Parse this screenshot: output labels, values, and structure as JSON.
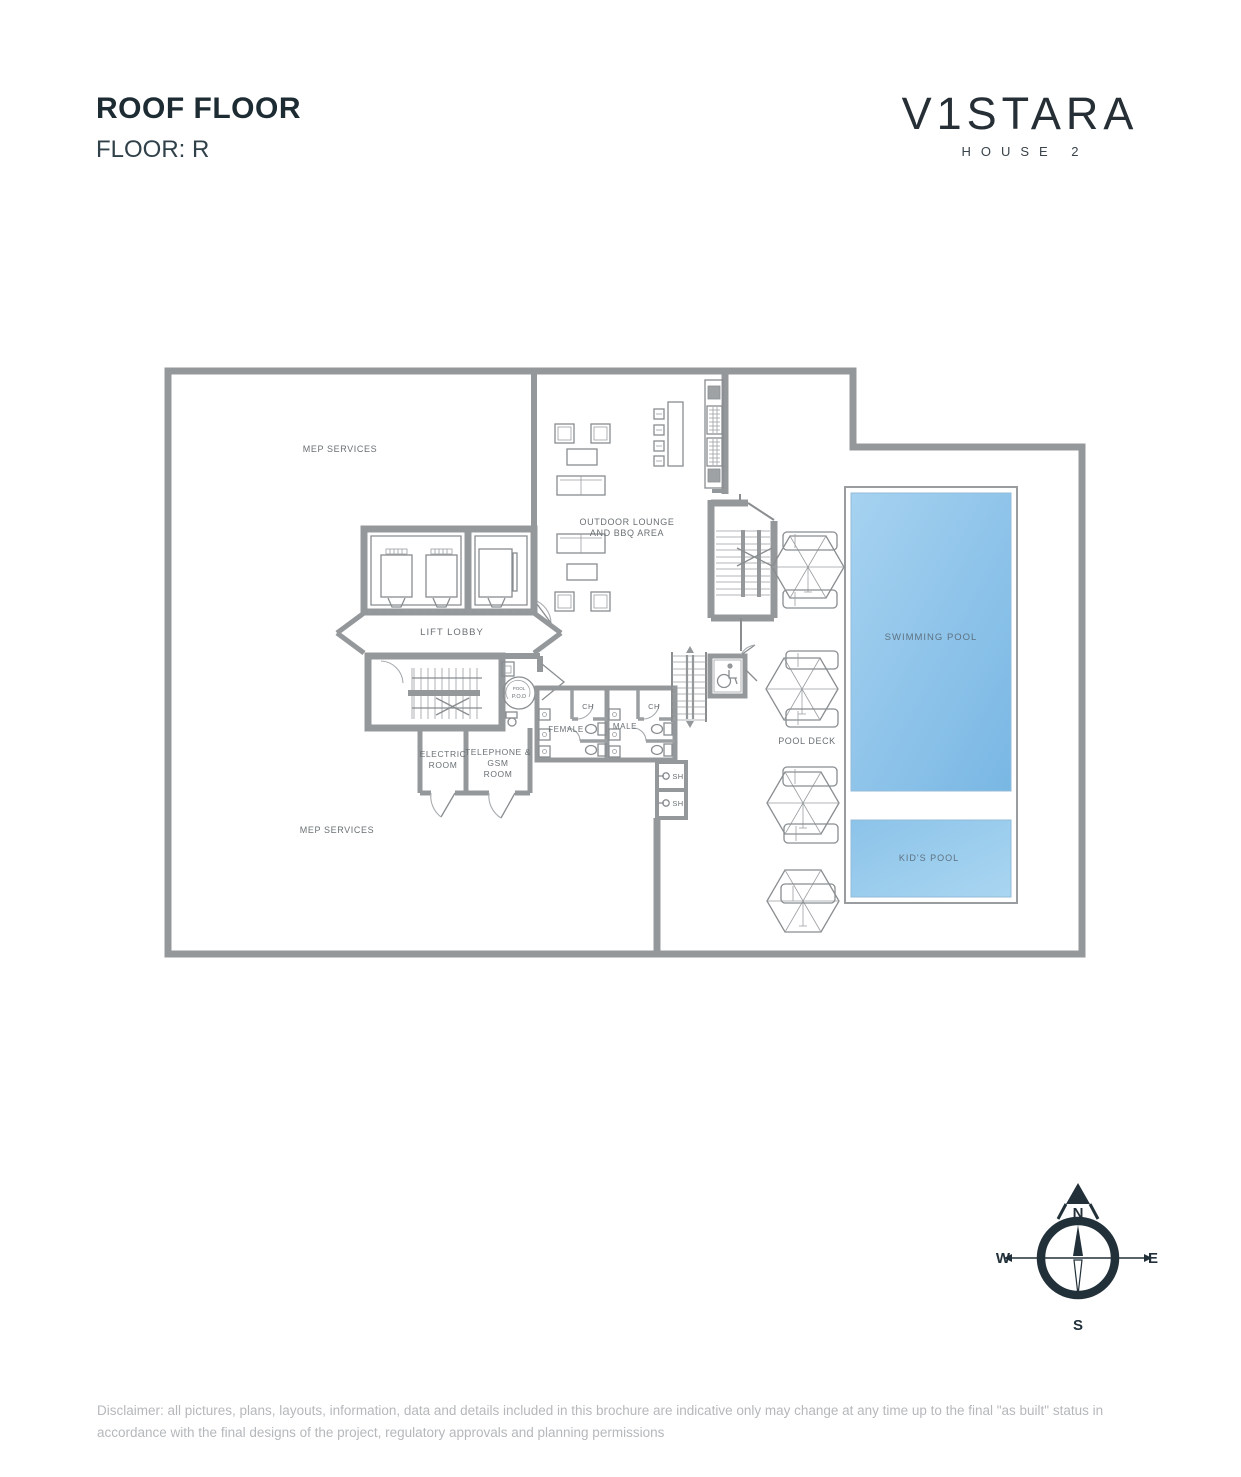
{
  "header": {
    "title": "ROOF FLOOR",
    "subtitle": "FLOOR: R"
  },
  "brand": {
    "name": "V1STARA",
    "subtitle": "HOUSE 2"
  },
  "plan": {
    "labels": {
      "mep_top": "MEP SERVICES",
      "mep_bottom": "MEP SERVICES",
      "lounge_line1": "OUTDOOR LOUNGE",
      "lounge_line2": "AND BBQ AREA",
      "lift_lobby": "LIFT LOBBY",
      "electric_line1": "ELECTRIC",
      "electric_line2": "ROOM",
      "telephone_line1": "TELEPHONE &",
      "telephone_line2": "GSM",
      "telephone_line3": "ROOM",
      "female": "FEMALE",
      "male": "MALE",
      "ch_left": "CH",
      "ch_right": "CH",
      "sh_top": "SH",
      "sh_bottom": "SH",
      "pod_line1": "POOL",
      "pod_line2": "P.O.D",
      "swimming_pool": "SWIMMING POOL",
      "kids_pool": "KID'S POOL",
      "pool_deck": "POOL DECK"
    }
  },
  "compass": {
    "north": "N",
    "south": "S",
    "east": "E",
    "west": "W"
  },
  "footer": {
    "disclaimer": "Disclaimer: all pictures, plans, layouts, information, data and details included in this brochure are indicative only may change at any time up to the final \"as built\" status in accordance with the final designs of the project, regulatory approvals and planning permissions"
  },
  "colors": {
    "wall": "#94989b",
    "line": "#898d90",
    "pool_light": "#a6d2f0",
    "pool_dark": "#79b7e4",
    "accent_dark": "#223039",
    "label": "#6a7074"
  }
}
